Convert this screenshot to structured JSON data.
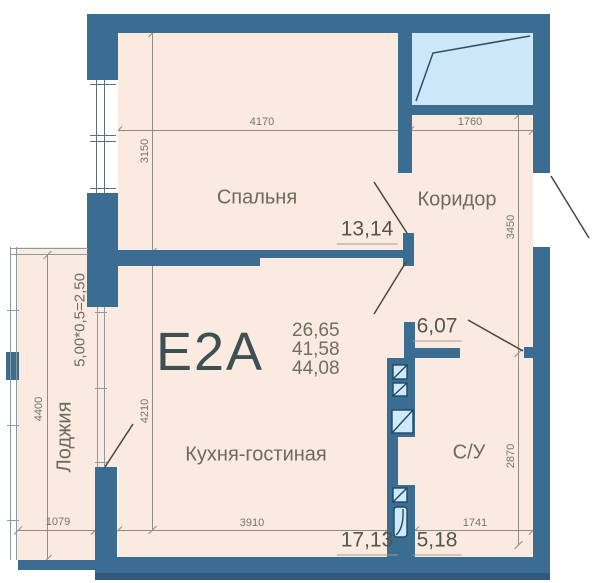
{
  "plan": {
    "unit_label": "Е2А",
    "area_summary": [
      "26,65",
      "41,58",
      "44,08"
    ],
    "rooms": {
      "bedroom": {
        "name": "Спальня",
        "area": "13,14"
      },
      "corridor": {
        "name": "Коридор"
      },
      "hallway": {
        "area": "6,07"
      },
      "kitchen_living": {
        "name": "Кухня-гостиная",
        "area": "17,13"
      },
      "bathroom": {
        "name": "С/У",
        "area": "5,18"
      },
      "loggia": {
        "name": "Лоджия",
        "area_formula": "5,00*0,5=2,50"
      }
    },
    "dimensions": {
      "bedroom_width": "4170",
      "bedroom_depth": "3150",
      "corridor_width": "1760",
      "corridor_depth": "3450",
      "kitchen_width": "3910",
      "kitchen_depth": "4210",
      "bathroom_width": "1741",
      "bathroom_depth": "2870",
      "loggia_width": "1079",
      "loggia_depth": "4400"
    },
    "colors": {
      "wall": "#3b6c92",
      "floor": "#faeadf",
      "window": "#cbe7f8",
      "dimension_text": "#75756d",
      "room_text": "#6b6b63",
      "unit_text": "#3e5052"
    }
  }
}
